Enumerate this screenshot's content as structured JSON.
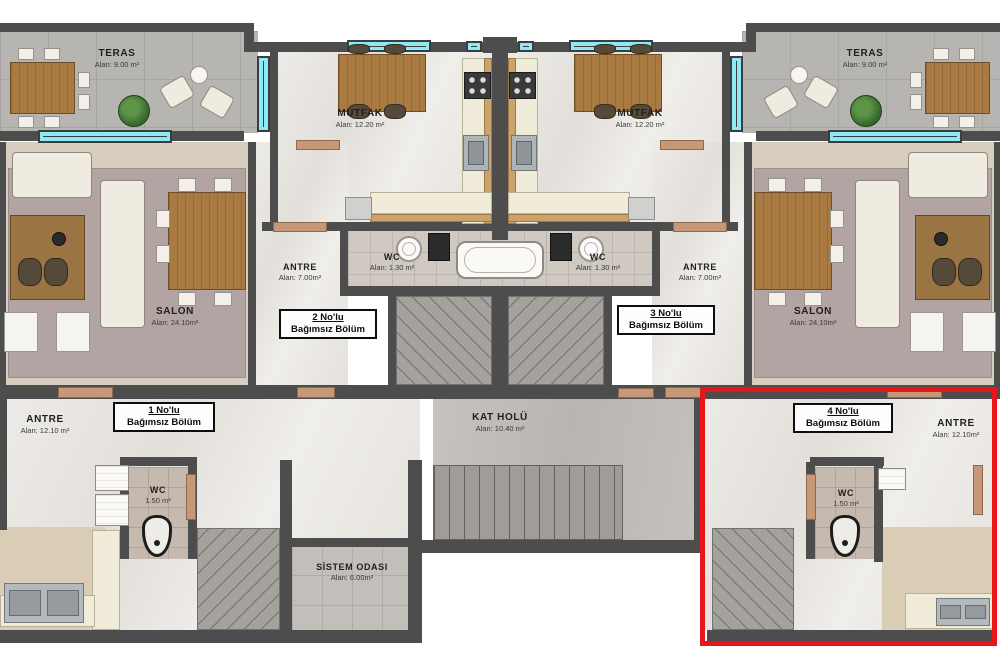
{
  "plan": {
    "type": "architectural-floor-plan",
    "highlight_color": "#e8151a",
    "wall_color": "#4d4d4d",
    "window_color": "#8ce9f6",
    "door_color": "#c69878",
    "units": {
      "u1": {
        "no": "1 No'lu",
        "type": "Bağımsız Bölüm"
      },
      "u2": {
        "no": "2 No'lu",
        "type": "Bağımsız Bölüm"
      },
      "u3": {
        "no": "3 No'lu",
        "type": "Bağımsız Bölüm"
      },
      "u4": {
        "no": "4 No'lu",
        "type": "Bağımsız Bölüm"
      }
    },
    "rooms": {
      "teras_left": {
        "name": "TERAS",
        "area": "Alan: 9.00 m²"
      },
      "teras_right": {
        "name": "TERAS",
        "area": "Alan: 9.00 m²"
      },
      "mutfak_left": {
        "name": "MUTFAK",
        "area": "Alan: 12.20 m²"
      },
      "mutfak_right": {
        "name": "MUTFAK",
        "area": "Alan: 12.20 m²"
      },
      "antre_2": {
        "name": "ANTRE",
        "area": "Alan: 7.00m²"
      },
      "antre_3": {
        "name": "ANTRE",
        "area": "Alan: 7.00m²"
      },
      "wc_2": {
        "name": "WC",
        "area": "Alan: 1.30 m²"
      },
      "wc_3": {
        "name": "WC",
        "area": "Alan: 1.30 m²"
      },
      "salon_left": {
        "name": "SALON",
        "area": "Alan: 24.10m²"
      },
      "salon_right": {
        "name": "SALON",
        "area": "Alan: 24.10m²"
      },
      "antre_1": {
        "name": "ANTRE",
        "area": "Alan: 12.10 m²"
      },
      "antre_4": {
        "name": "ANTRE",
        "area": "Alan: 12.10m²"
      },
      "wc_1": {
        "name": "WC",
        "area": "1.50 m²"
      },
      "wc_4": {
        "name": "WC",
        "area": "1.50 m²"
      },
      "kat_holu": {
        "name": "KAT HOLÜ",
        "area": "Alan: 10.40 m²"
      },
      "sistem_odasi": {
        "name": "SİSTEM ODASI",
        "area": "Alan: 6.00m²"
      }
    },
    "icons": {
      "plant": "potted-plant",
      "bathtub": "bathtub",
      "sink": "round-sink",
      "stove": "4-burner-stove",
      "urinal": "toilet-fixture",
      "stairs": "stair-treads"
    }
  }
}
